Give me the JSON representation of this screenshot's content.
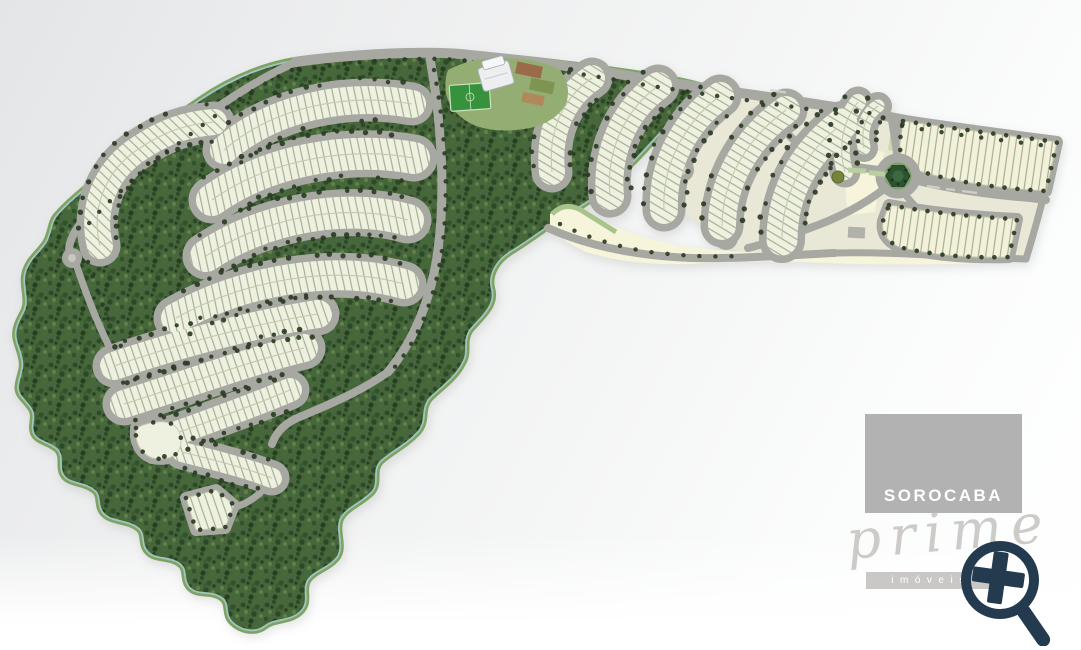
{
  "title": "Residential development master plan (loteamento) site map",
  "watermark": {
    "brand": "SOROCABA",
    "brand_script": "prime",
    "brand_sub": "imóveis",
    "box_color": "#b2b2b2",
    "bar_color": "#c9c8c6",
    "text_color": "#ffffff",
    "script_color": "#bcbbb7",
    "icon": "magnifier-plus-icon",
    "icon_color": "#243a4f"
  },
  "map": {
    "kind": "site-plan",
    "features": {
      "forest": "preserved native forest",
      "lot_blocks": "residential lot blocks with individual lot divisions",
      "roads": "internal winding streets with street trees",
      "roundabout": "landscaped roundabout",
      "clubhouse": "clubhouse with sports court and soccer field",
      "open_areas": "open lawn / future phase areas",
      "cul_de_sacs": "cul-de-sac turnarounds"
    },
    "colors": {
      "forest_base": "#47663c",
      "forest_dark": "#2c4a28",
      "forest_mid": "#31512c",
      "forest_light": "#5d8247",
      "forest_edge": "#7fa263",
      "coast_line": "#9fc6bf",
      "road": "#a7a8a2",
      "road_fill": "#e9e7d6",
      "lot_fill": "#eff1e0",
      "lot_fill_warm": "#f3f1da",
      "lot_tick": "#9aa68a",
      "lot_edge": "#c6cbb2",
      "lot_center": "#c3c9ae",
      "open_area": "#f6f4da",
      "open_green": "#c8dcab",
      "tree_dot": "#2b3b25",
      "roundabout_green": "#2d5331",
      "roundabout_lawn": "#7fa268",
      "field_green": "#37923e",
      "field_line": "#cfe3c3",
      "court_brown": "#9a6a4b",
      "garden_green": "#7d9551",
      "garden_tan": "#b0885c",
      "building": "#eceef0",
      "building_edge": "#a9adb4",
      "median_green": "#b9cf9e",
      "olive_circle": "#75833c",
      "label_dash": "#d6d6cc"
    }
  }
}
